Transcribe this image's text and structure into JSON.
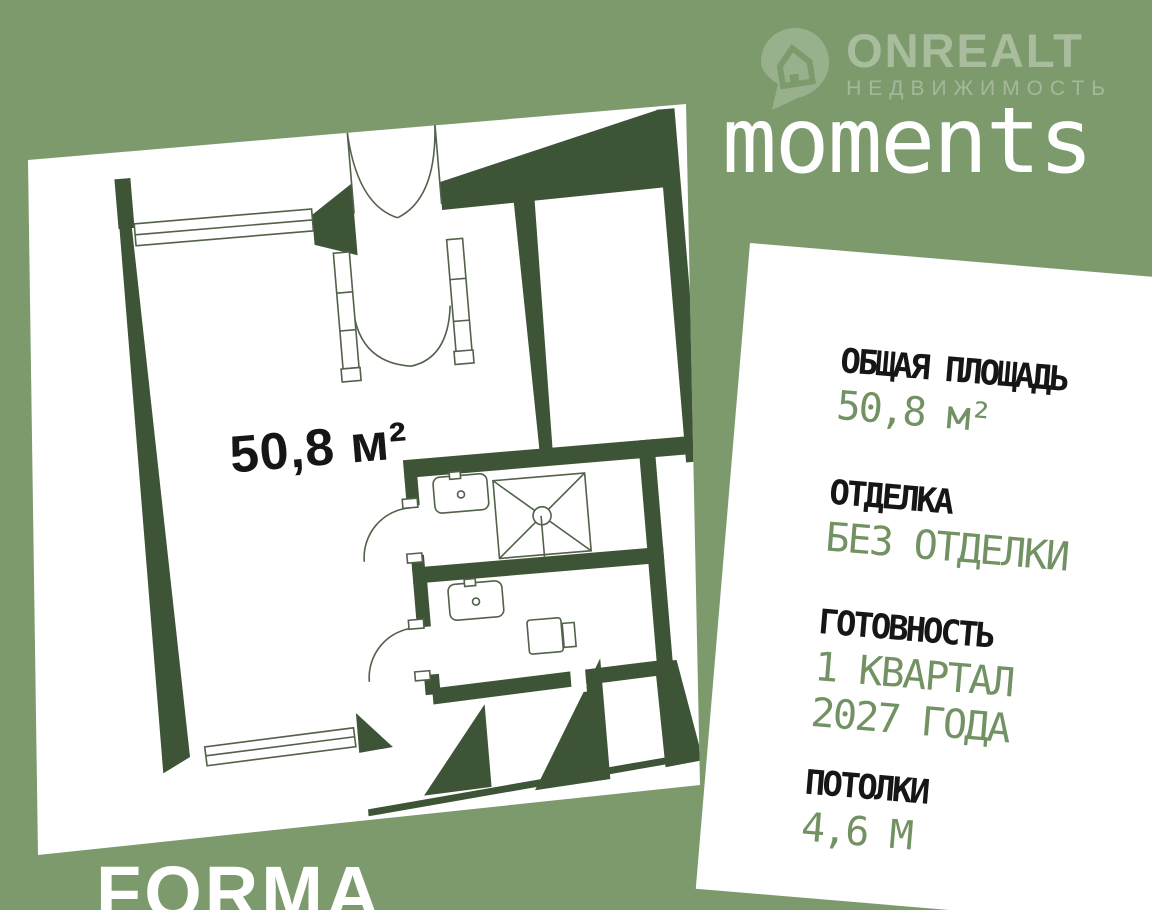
{
  "colors": {
    "background": "#7d9a6d",
    "wall_dark_green": "#3e5436",
    "accent_green": "#739264",
    "text_dark": "#161616",
    "card_white": "#ffffff"
  },
  "watermark": {
    "brand": "ONREALT",
    "tagline": "НЕДВИЖИМОСТЬ",
    "icon": "onrealt-pin-icon"
  },
  "project": {
    "title": "moments"
  },
  "floorplan": {
    "area_label": "50,8 м²"
  },
  "specs": [
    {
      "label": "ОБЩАЯ ПЛОЩАДЬ",
      "value": "50,8 м²"
    },
    {
      "label": "ОТДЕЛКА",
      "value": "БЕЗ ОТДЕЛКИ"
    },
    {
      "label": "ГОТОВНОСТЬ",
      "value": "1 КВАРТАЛ\n2027 ГОДА"
    },
    {
      "label": "ПОТОЛКИ",
      "value": "4,6 М"
    }
  ],
  "developer": {
    "name": "FORMA"
  }
}
